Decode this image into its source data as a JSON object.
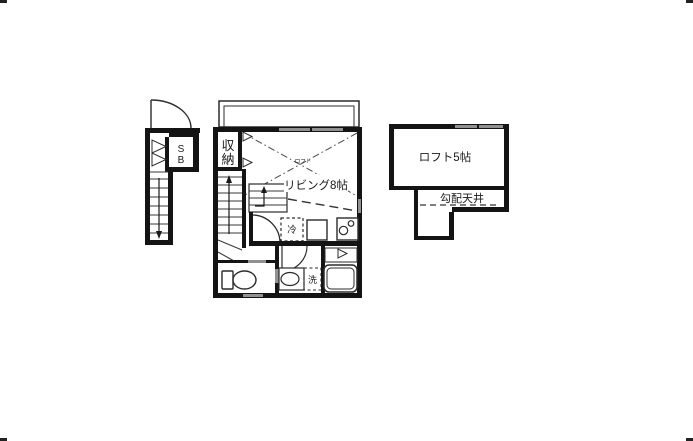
{
  "colors": {
    "background": "#ffffff",
    "wall": "#141414",
    "line": "#2b2b2b",
    "window_gray": "#919191"
  },
  "plan": {
    "exterior_stair": {
      "shoebox": {
        "line1": "S",
        "line2": "B"
      }
    },
    "main_unit": {
      "closet": {
        "line1": "収",
        "line2": "納"
      },
      "living_label": "リビング8帖",
      "loft_above_note": "ロフト",
      "fridge_label": "冷",
      "washer_label": "洗"
    },
    "loft": {
      "name_label": "ロフト5帖",
      "sloped_ceiling_label": "勾配天井"
    }
  }
}
